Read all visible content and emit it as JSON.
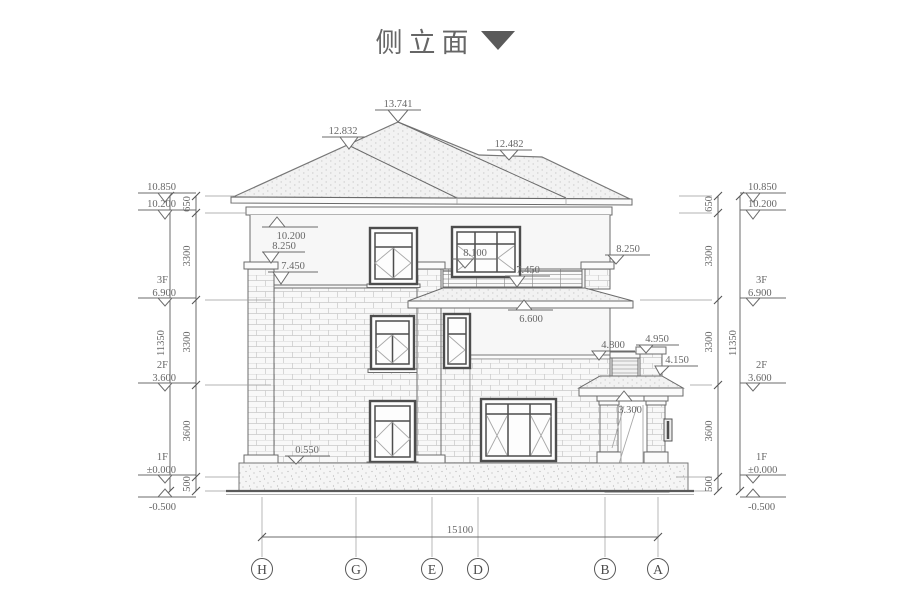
{
  "title": {
    "text": "侧立面",
    "arrow": "▼"
  },
  "marks": {
    "peak": "13.741",
    "ridge_left": "12.832",
    "ridge_right": "12.482",
    "eave": "10.200",
    "cap_left": "8.250",
    "band_left": "7.450",
    "balcony_top": "8.100",
    "balcony_band": "7.450",
    "cap_right": "8.250",
    "canopy": "6.600",
    "parapet": "4.800",
    "pillar": "4.950",
    "porch_ridge": "4.150",
    "porch": "3.300",
    "plinth": "0.550"
  },
  "chain": {
    "top": "10.850",
    "eave": "10.200",
    "floors": [
      {
        "label": "3F",
        "value": "6.900"
      },
      {
        "label": "2F",
        "value": "3.600"
      },
      {
        "label": "1F",
        "value": "±0.000"
      }
    ],
    "ground": "-0.500",
    "segments": [
      "650",
      "3300",
      "3300",
      "3600",
      "500"
    ],
    "overall": "11350"
  },
  "bottom": {
    "overall": "15100",
    "axes": [
      "H",
      "G",
      "E",
      "D",
      "B",
      "A"
    ]
  },
  "colors": {
    "line": "#6b6b6b",
    "dim_text": "#676767",
    "window_frame": "#4d4d4d",
    "wall": "#f7f7f7",
    "roof_fill": "#f2f2f2",
    "title": "#666666",
    "arrow": "#5a5a5a"
  }
}
